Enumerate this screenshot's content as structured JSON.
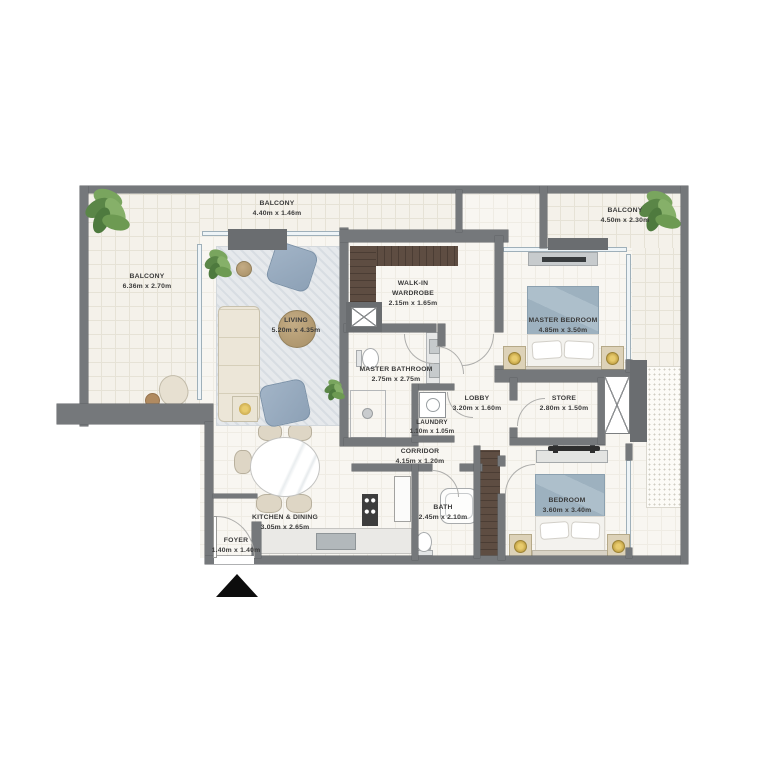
{
  "colors": {
    "wall": "#75787b",
    "floor": "#f8f6f1",
    "balcony_floor": "#f4f1ea",
    "wood_wardrobe": "#5e4d42",
    "bed_blanket": "#9db1bf",
    "armchair": "#8da1b6",
    "lamp_gold": "#c9a94e",
    "plant_green": "#6d9a52",
    "label_text": "#3a3a3a",
    "entry_marker": "#0d0d0d"
  },
  "rooms": {
    "balcony_left": {
      "label": "BALCONY",
      "dims": "6.36m x 2.70m"
    },
    "balcony_top": {
      "label": "BALCONY",
      "dims": "4.40m x 1.46m"
    },
    "balcony_right": {
      "label": "BALCONY",
      "dims": "4.50m x 2.30m"
    },
    "living": {
      "label": "LIVING",
      "dims": "5.20m x 4.35m"
    },
    "walk_in_wardrobe": {
      "label": "WALK-IN WARDROBE",
      "dims": "2.15m x 1.65m"
    },
    "master_bedroom": {
      "label": "MASTER BEDROOM",
      "dims": "4.85m x 3.50m"
    },
    "master_bathroom": {
      "label": "MASTER BATHROOM",
      "dims": "2.75m x 2.75m"
    },
    "lobby": {
      "label": "LOBBY",
      "dims": "3.20m x 1.60m"
    },
    "store": {
      "label": "STORE",
      "dims": "2.80m x 1.50m"
    },
    "laundry": {
      "label": "LAUNDRY",
      "dims": "1.10m x 1.05m"
    },
    "corridor": {
      "label": "CORRIDOR",
      "dims": "4.15m x 1.20m"
    },
    "bedroom": {
      "label": "BEDROOM",
      "dims": "3.60m x 3.40m"
    },
    "kitchen_dining": {
      "label": "KITCHEN & DINING",
      "dims": "3.05m x 2.65m"
    },
    "bath": {
      "label": "BATH",
      "dims": "2.45m x 2.10m"
    },
    "foyer": {
      "label": "FOYER",
      "dims": "1.40m x 1.40m"
    }
  }
}
